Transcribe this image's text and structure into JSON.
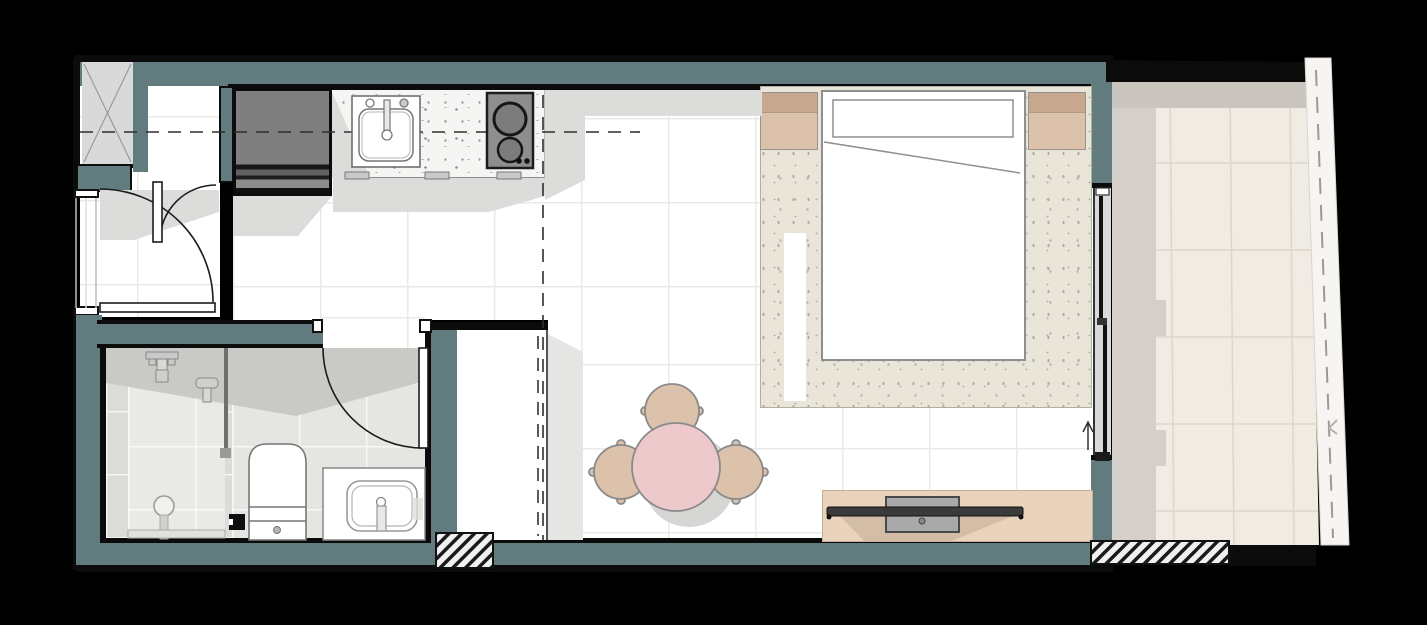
{
  "meta": {
    "title": "studio-apartment-floor-plan",
    "type": "architectural-floor-plan",
    "text_labels_visible": "none"
  },
  "palette": {
    "background": "#000000",
    "wall_fill": "#627b7e",
    "wall_outline": "#0b0b0b",
    "floor_tile": "#ffffff",
    "tile_grout": "#e9e9e7",
    "shadow": "#d9d9d7",
    "counter_terrazzo": "#f5f5f3",
    "bathroom_floor": "#dbdbd7",
    "rug": "#eae5d9",
    "wood_tan": "#dcc1ab",
    "wood_tan_dark": "#c7a78d",
    "table_pink": "#eec9cc",
    "tv_cabinet_tan": "#ead3bd",
    "tv_screen": "#3a3a3a",
    "appliance_gray": "#8e8e8e",
    "balcony_floor": "#f0ebe3",
    "balustrade": "#f7f5f1"
  },
  "rooms": {
    "entry": {
      "label": "entry hall",
      "features": [
        "utility-shaft-with-x-brace",
        "entry-door-swing-arcs",
        "corridor-window"
      ]
    },
    "kitchen": {
      "label": "kitchenette",
      "features": [
        "refrigerator",
        "terrazzo-countertop",
        "sink-with-faucet",
        "cooktop-two-burners-two-knobs",
        "three-cabinet-handles",
        "section-cut-dashed-line"
      ]
    },
    "bathroom": {
      "label": "bathroom",
      "features": [
        "walk-in-shower",
        "shower-head",
        "hand-shower",
        "glass-partition",
        "round-floor-drain",
        "linear-drain",
        "toilet",
        "vanity-sink",
        "floor-drain-box",
        "inward-swinging-door"
      ]
    },
    "living": {
      "label": "living / dining area",
      "features": [
        "wardrobe-with-dashed-sliding-front",
        "round-dining-table",
        "three-chairs",
        "tv-console",
        "wall-mounted-tv",
        "media-unit"
      ]
    },
    "bedroom": {
      "label": "sleeping area",
      "features": [
        "double-bed",
        "headboard",
        "duvet-fold-line",
        "two-nightstands",
        "area-rug",
        "bed-runner"
      ]
    },
    "balcony": {
      "label": "balcony",
      "features": [
        "sliding-glass-door-two-panels",
        "slide-direction-arrow",
        "tiled-floor",
        "glass-balustrade-dashed",
        "hatched-wall-sections"
      ]
    }
  },
  "counts": {
    "chairs": 3,
    "nightstands": 2,
    "burners": 2,
    "sliding_panels": 2,
    "hatch_blocks": 2
  }
}
